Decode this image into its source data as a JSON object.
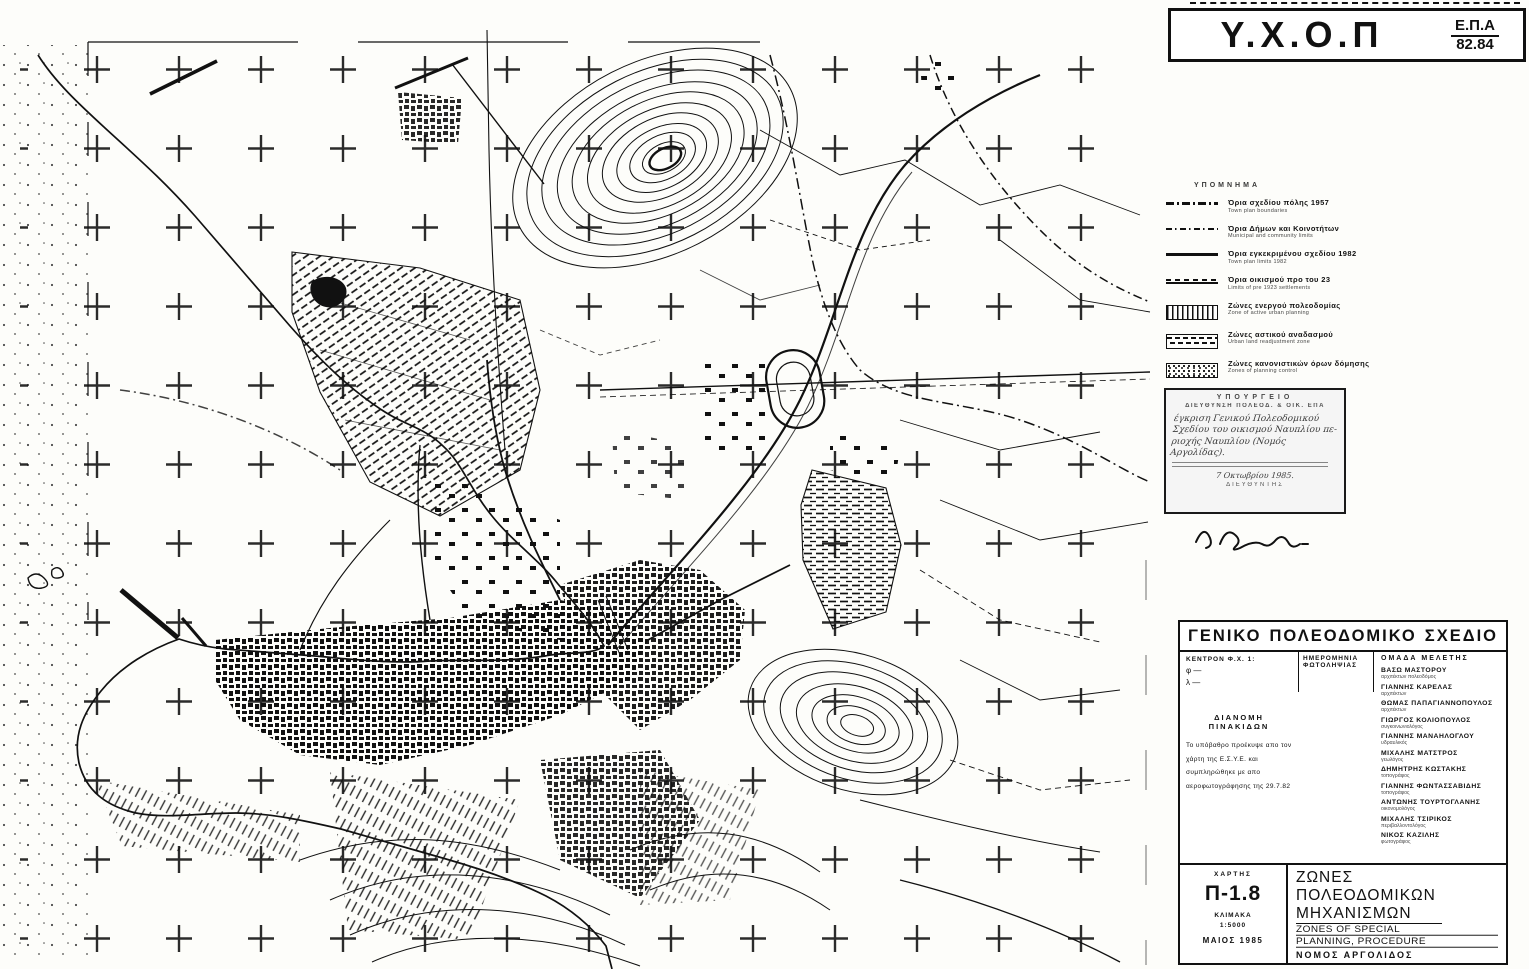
{
  "header": {
    "agency": "Υ.Χ.Ο.Π",
    "program": "Ε.Π.Α",
    "program_years": "82.84"
  },
  "legend": {
    "title": "ΥΠΟΜΝΗΜΑ",
    "line_items": [
      {
        "gr": "Όρια σχεδίου πόλης 1957",
        "en": "Town plan boundaries",
        "swatch": "dash-dot-thick-line"
      },
      {
        "gr": "Όρια Δήμων και Κοινοτήτων",
        "en": "Municipal and community limits",
        "swatch": "dash-dot-thin-line"
      },
      {
        "gr": "Όρια εγκεκριμένου σχεδίου 1982",
        "en": "Town plan limits 1982",
        "swatch": "solid-line"
      },
      {
        "gr": "Όρια οικισμού προ του 23",
        "en": "Limits of pre 1923 settlements",
        "swatch": "solid-dashed-double-line"
      }
    ],
    "zone_items": [
      {
        "gr": "Ζώνες ενεργού πολεοδομίας",
        "en": "Zone of active urban planning",
        "swatch": "vertical-hatch-box"
      },
      {
        "gr": "Ζώνες αστικού αναδασμού",
        "en": "Urban land readjustment zone",
        "swatch": "dashed-hatch-box"
      },
      {
        "gr": "Ζώνες κανονιστικών όρων δόμησης",
        "en": "Zones of planning control",
        "swatch": "dotted-box"
      },
      {
        "gr": "Ζώνες αγοράς συντελεστή",
        "en": "Zones of transfer development rights",
        "swatch": "wavy-line-zas",
        "zas_label": "ΖΑΣ"
      }
    ]
  },
  "stamp": {
    "cap1": "ΥΠΟΥΡΓΕΙΟ",
    "cap2": "ΔΙΕΥΘΥΝΣΗ ΠΟΛΕΟΔ. & ΟΙΚ. ΕΠΑ",
    "hand1": "έγκριση Γενικού Πολεοδομικού",
    "hand2": "Σχεδίου του οικισμού Ναυπλίου πε-",
    "hand3": "ριοχής Ναυπλίου (Νομός Αργολίδας).",
    "hand4": "7 Οκτωβρίου 1985.",
    "director": "ΔΙΕΥΘΥΝΤΗΣ"
  },
  "title_block": {
    "title": "ΓΕΝΙΚΟ ΠΟΛΕΟΔΟΜΙΚΟ ΣΧΕΔΙΟ",
    "title_w1": "ΓΕΝΙΚΟ",
    "title_w2": "ΠΟΛΕΟΔΟΜΙΚΟ",
    "title_w3": "ΣΧΕΔΙΟ",
    "center_label": "ΚΕΝΤΡΟΝ Φ.Χ. 1:",
    "phi": "φ —",
    "lambda": "λ —",
    "photo_date_label1": "ΗΜΕΡΟΜΗΝΙΑ",
    "photo_date_label2": "ΦΩΤΟΛΗΨΙΑΣ",
    "team_label": "ΟΜΑΔΑ  ΜΕΛΕΤΗΣ",
    "team": [
      {
        "name": "ΒΑΣΩ ΜΑΣΤΟΡΟΥ",
        "role": "αρχιτέκτων πολεοδόμος"
      },
      {
        "name": "ΓΙΑΝΝΗΣ ΚΑΡΕΛΑΣ",
        "role": "αρχιτέκτων"
      },
      {
        "name": "ΘΩΜΑΣ ΠΑΠΑΓΙΑΝΝΟΠΟΥΛΟΣ",
        "role": "αρχιτέκτων"
      },
      {
        "name": "ΓΙΩΡΓΟΣ ΚΟΛΙΟΠΟΥΛΟΣ",
        "role": "συγκοινωνιολόγος"
      },
      {
        "name": "ΓΙΑΝΝΗΣ ΜΑΝΑΗΛΟΓΛΟΥ",
        "role": "υδραυλικός"
      },
      {
        "name": "ΜΙΧΑΛΗΣ ΜΑΤΣΤΡΟΣ",
        "role": "γεωλόγος"
      },
      {
        "name": "ΔΗΜΗΤΡΗΣ ΚΩΣΤΑΚΗΣ",
        "role": "τοπογράφος"
      },
      {
        "name": "ΓΙΑΝΝΗΣ ΦΩΝΤΑΣΣΑΒΙΔΗΣ",
        "role": "τοπογράφος"
      },
      {
        "name": "ΑΝΤΩΝΗΣ ΤΟΥΡΤΟΓΛΑΝΗΣ",
        "role": "οικονομολόγος"
      },
      {
        "name": "ΜΙΧΑΛΗΣ ΤΣΙΡΙΚΟΣ",
        "role": "περιβαλλοντολόγος"
      },
      {
        "name": "ΝΙΚΟΣ ΚΑΖΙΛΗΣ",
        "role": "φωτογράφος"
      }
    ],
    "distribution_title": "ΔΙΑΝΟΜΗ  ΠΙΝΑΚΙΔΩΝ",
    "distribution_note": "Το υπόβαθρο προέκυψε απο τον χάρτη της Ε.Σ.Υ.Ε. και συμπληρώθηκε με απο αεροφωτογράφησης της 29.7.82",
    "map_label": "ΧΑΡΤΗΣ",
    "map_no": "Π-1.8",
    "scale_label": "ΚΛΙΜΑΚΑ",
    "scale": "1:5000",
    "date": "ΜΑΙΟΣ 1985",
    "subject_gr1": "ΖΩΝΕΣ ΠΟΛΕΟΔΟΜΙΚΩΝ",
    "subject_gr2": "ΜΗΧΑΝΙΣΜΩΝ",
    "subject_en1": "ZONES OF SPECIAL",
    "subject_en2": "PLANNING, PROCEDURE",
    "prefecture": "ΝΟΜΟΣ  ΑΡΓΟΛΙΔΟΣ"
  }
}
